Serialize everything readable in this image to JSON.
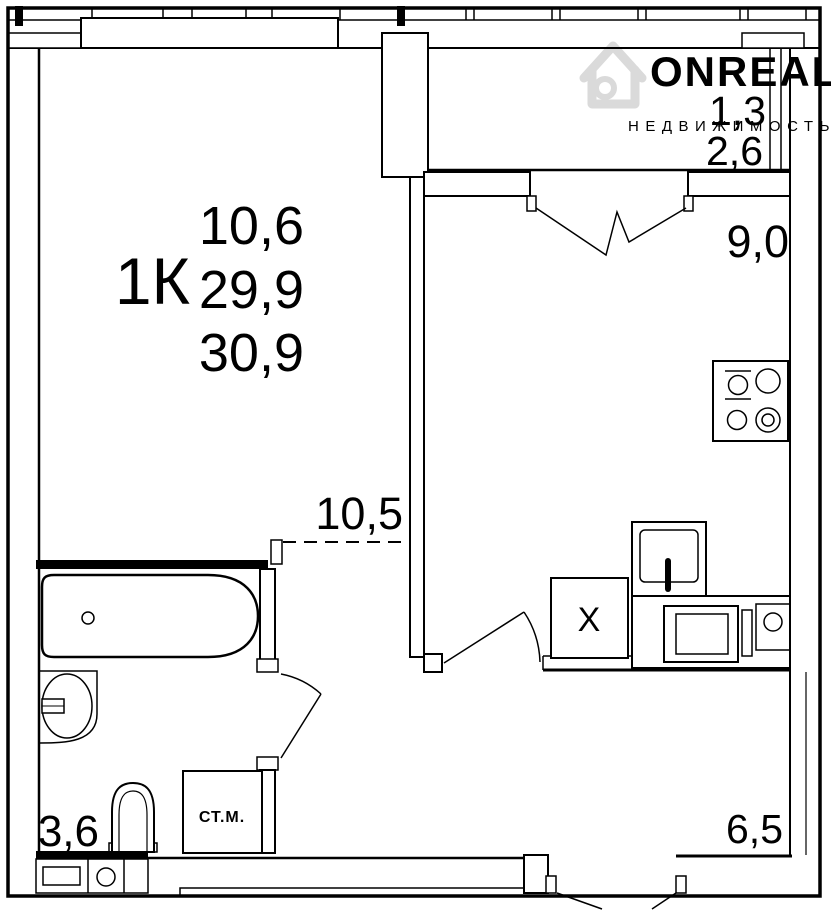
{
  "plan": {
    "labels": {
      "unit_type": "1К",
      "room_area": "10,6",
      "living_area": "29,9",
      "total_area": "30,9",
      "zone_area": "10,5",
      "kitchen_area": "9,0",
      "balcony_area_reduced": "1,3",
      "balcony_area_full": "2,6",
      "bathroom_area": "3,6",
      "hallway_area": "6,5",
      "fridge_mark": "X",
      "washing_machine": "СТ.М."
    },
    "watermark": {
      "brand": "ONREALT",
      "subtitle": "НЕДВИЖИМОСТЬ"
    },
    "colors": {
      "background": "#ffffff",
      "line": "#000000",
      "watermark_logo": "#dadada",
      "watermark_brand": "#d6d6d6",
      "watermark_subtitle": "#e2e2e2"
    }
  }
}
